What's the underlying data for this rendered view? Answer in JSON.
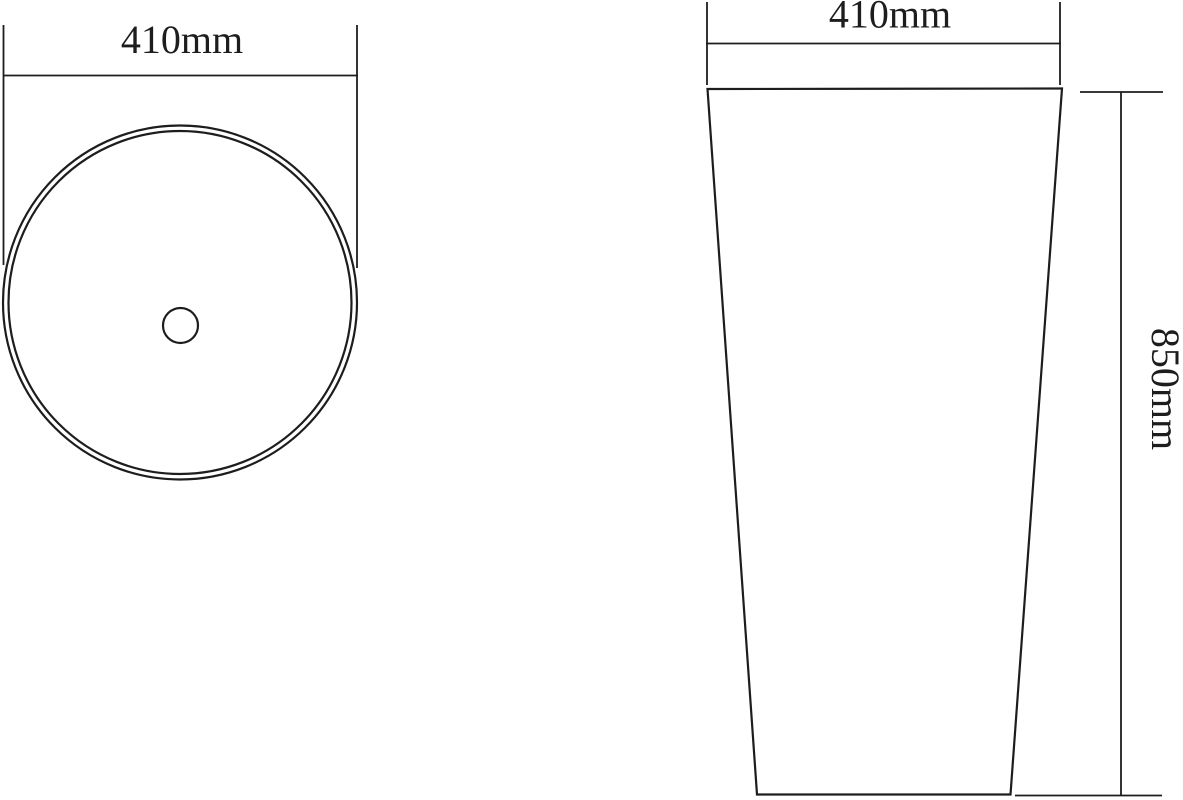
{
  "page": {
    "background_color": "#ffffff",
    "line_color": "#1d1d1d",
    "description": "Two-view technical dimension drawing of a round pedestal basin"
  },
  "top_view": {
    "name": "basin top view",
    "diameter_dimension": {
      "label": "410mm"
    },
    "features": [
      "outer-rim-circle",
      "inner-rim-circle",
      "drain-hole-circle"
    ]
  },
  "front_view": {
    "name": "pedestal front view",
    "width_dimension": {
      "label": "410mm"
    },
    "height_dimension": {
      "label": "850mm"
    },
    "features": [
      "tapered-pedestal-outline"
    ]
  }
}
